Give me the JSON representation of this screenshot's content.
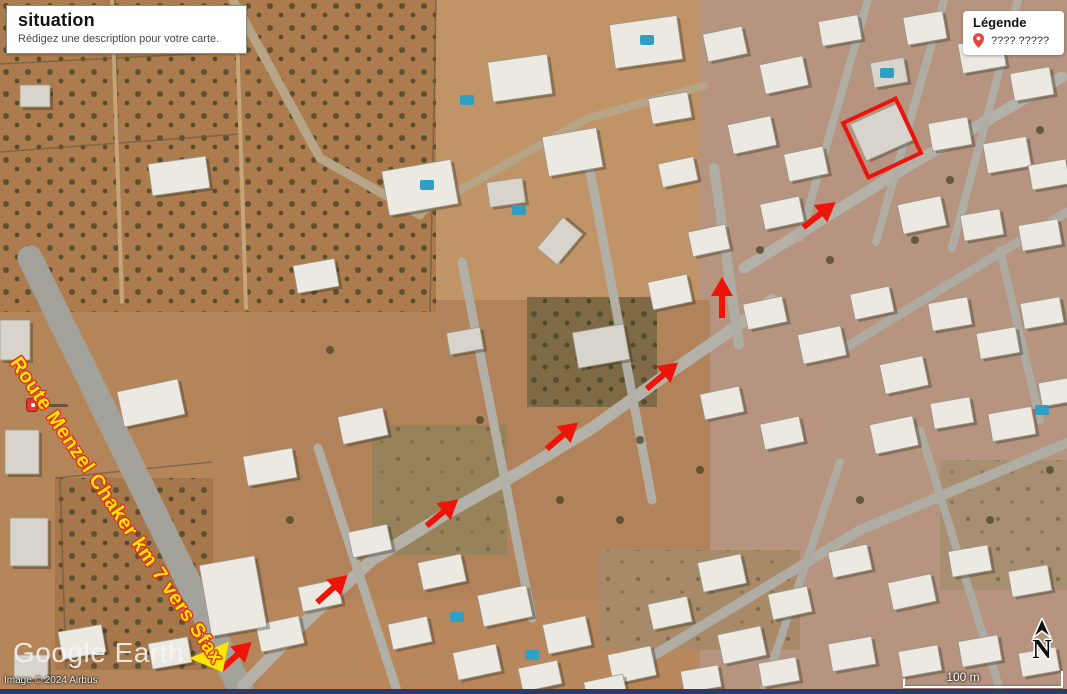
{
  "title_box": {
    "title": "situation",
    "subtitle": "Rédigez une description pour votre carte."
  },
  "legend": {
    "title": "Légende",
    "item_label": "???? ?????",
    "pin_color": "#e5453c"
  },
  "road_label": {
    "text": "Route Menzel Chaker km 7 vers Sfax",
    "x": 14,
    "y": 348,
    "angle": 56,
    "color": "#ffe600",
    "outline_color": "#e03020"
  },
  "watermark": {
    "brand": "Google Earth",
    "copyright": "Image © 2024 Airbus"
  },
  "scale_bar": {
    "label": "100 m"
  },
  "north_indicator": {
    "label": "N"
  },
  "annotations": {
    "arrow_color": "#ee1407",
    "route_arrows": [
      {
        "x": 236,
        "y": 656,
        "angle": -42
      },
      {
        "x": 332,
        "y": 589,
        "angle": -42
      },
      {
        "x": 442,
        "y": 513,
        "angle": -40
      },
      {
        "x": 562,
        "y": 436,
        "angle": -40
      },
      {
        "x": 662,
        "y": 376,
        "angle": -40
      },
      {
        "x": 722,
        "y": 298,
        "angle": -90
      },
      {
        "x": 819,
        "y": 215,
        "angle": -38
      }
    ],
    "yellow_arrowhead": {
      "x": 209,
      "y": 654,
      "angle": 8,
      "color": "#ffe600"
    },
    "target_rectangle": {
      "x": 882,
      "y": 138,
      "w": 62,
      "h": 64,
      "angle": -25,
      "color": "#e8150d"
    },
    "poi_pin": {
      "x": 26,
      "y": 398
    }
  }
}
